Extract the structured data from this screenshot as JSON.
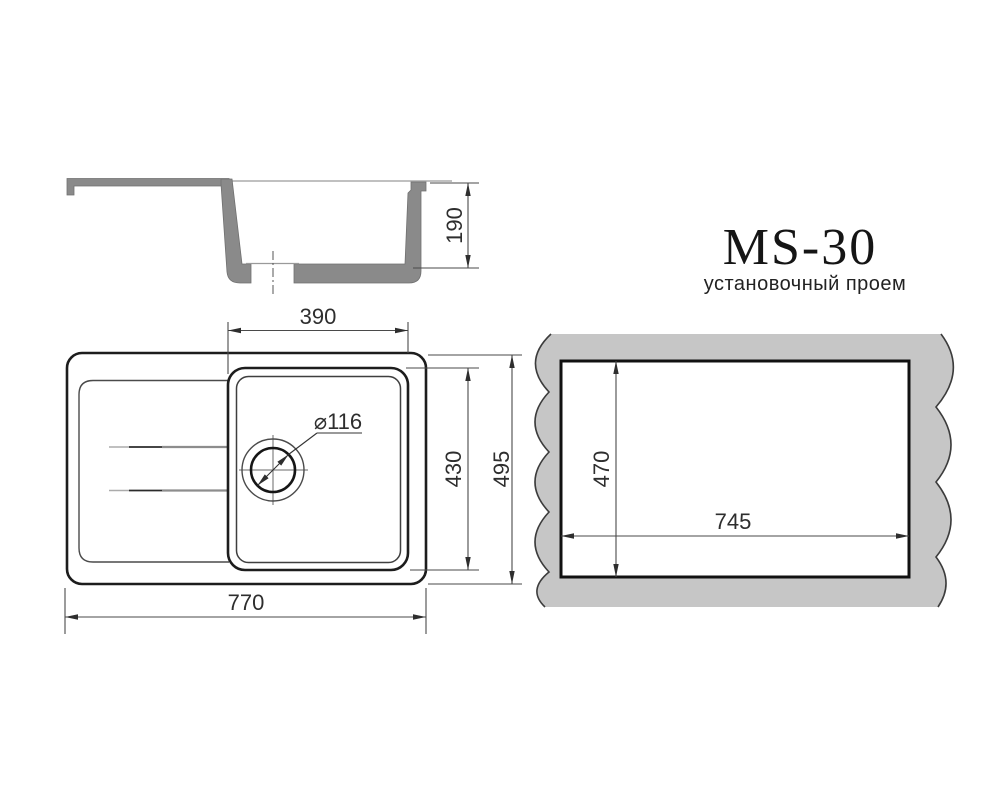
{
  "title_block": {
    "model": "MS-30",
    "subtitle": "установочный проем"
  },
  "colors": {
    "outline": "#1d1d1d",
    "thin_line": "#3c3c3c",
    "dim_line": "#4a4a4a",
    "light_line": "#9a9a9a",
    "section_fill": "#8a8a8a",
    "panel_fill": "#c6c6c6",
    "background": "#ffffff"
  },
  "section_view": {
    "dims": {
      "depth": "190"
    }
  },
  "plan_view": {
    "dims": {
      "bowl_width": "390",
      "bowl_depth": "430",
      "overall_depth": "495",
      "overall_width": "770",
      "drain_diameter": "⌀116"
    }
  },
  "opening_view": {
    "dims": {
      "height": "470",
      "width": "745"
    }
  }
}
